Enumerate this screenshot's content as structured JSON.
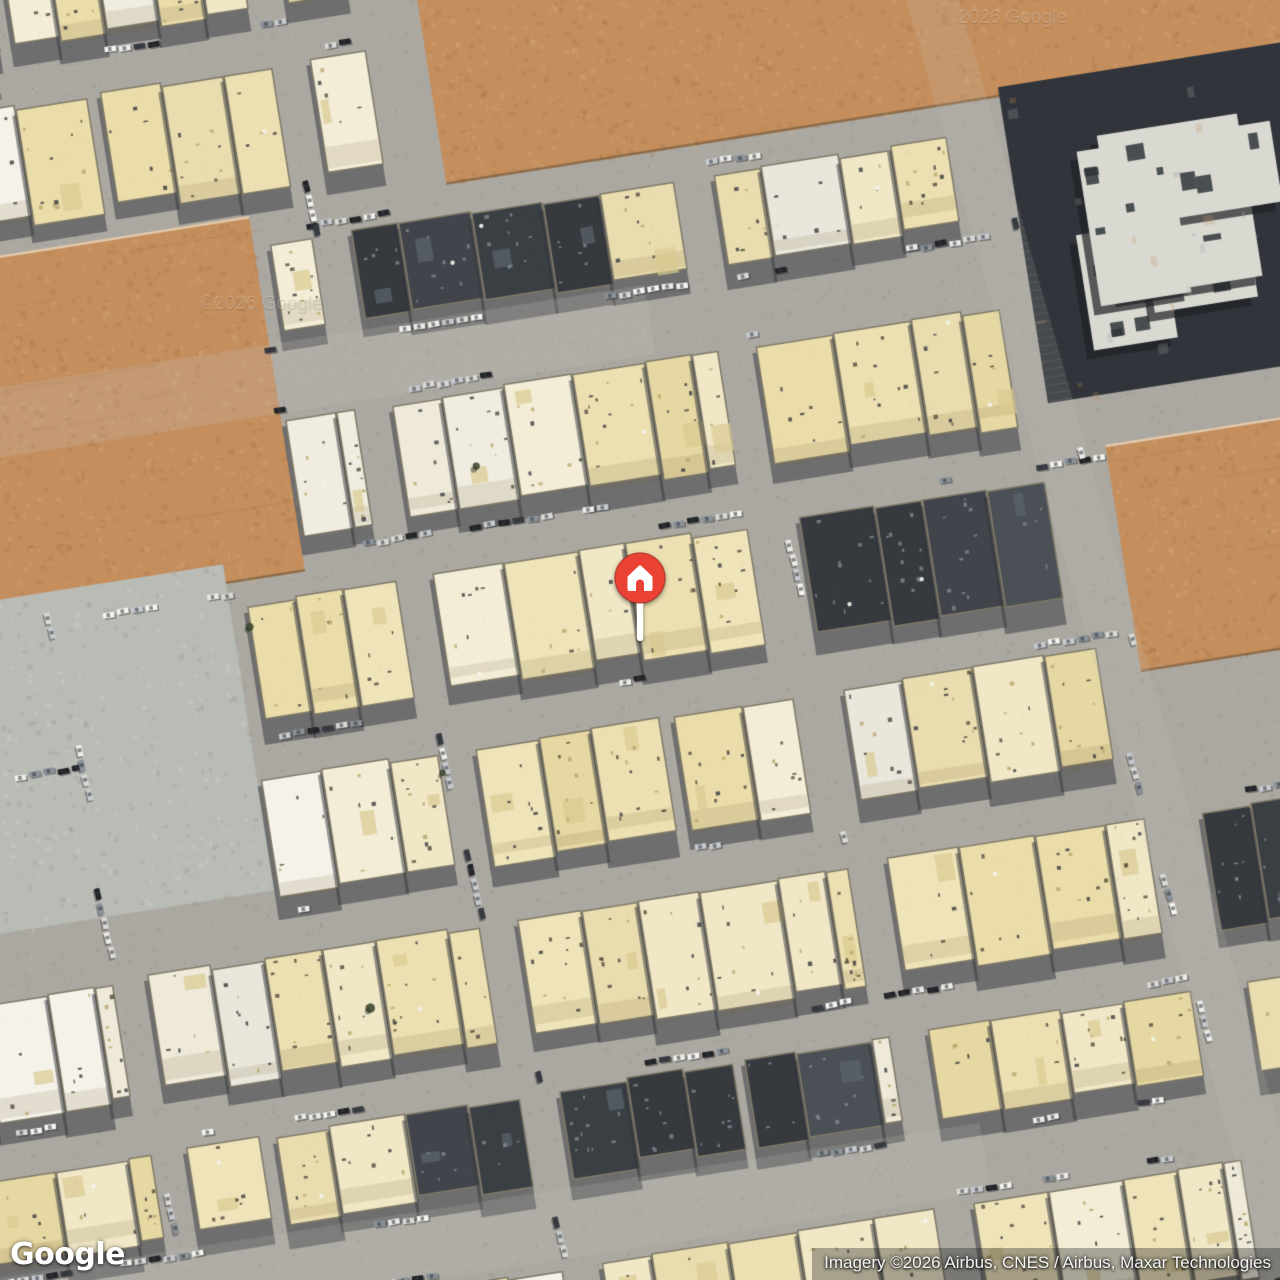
{
  "map": {
    "view_type": "satellite",
    "rotation_deg": -9,
    "seed": 1337,
    "palette": {
      "street": "#a8a5a0",
      "street_light": "#c2c0ba",
      "shadow": "#282c33",
      "house": [
        "#ebdda9",
        "#efe3b9",
        "#e6d7a1",
        "#f1e7c8",
        "#ecdfb0",
        "#f4eed9",
        "#e9dcae"
      ],
      "house_light": [
        "#f1ede1",
        "#efe9da",
        "#f6f3ec",
        "#e9e6dd"
      ],
      "house_dark": [
        "#383d45",
        "#31363e",
        "#424850",
        "#2d3138"
      ],
      "sand": "#c38a58",
      "sand_dark": "#a06a3c",
      "sand_light": "#d9ae82",
      "pavement": "#b7b9b5",
      "estate_roof": "#d8d9d3",
      "estate_dark": "#272b33",
      "tree": "#36412a",
      "car": [
        "#f6f6f4",
        "#ececea",
        "#17191e",
        "#2f333b",
        "#868e98",
        "#c6cad0",
        "#d9d9d7"
      ]
    },
    "rows": {
      "pitch": 176,
      "band": 130,
      "start": -340,
      "wide_rows": [
        3,
        8
      ],
      "wide_band": 100
    },
    "vstreets": [
      {
        "x": 60,
        "w": 30,
        "lean": 0.07
      },
      {
        "x": 430,
        "w": 34,
        "lean": 0.08
      },
      {
        "x": 800,
        "w": 34,
        "lean": 0.09
      },
      {
        "x": 1100,
        "w": 52,
        "lean": 0.12,
        "main": true
      },
      {
        "x": 1460,
        "w": 34,
        "lean": 0.08
      }
    ],
    "zones": {
      "sand": [
        [
          520,
          -360,
          1160,
          520
        ],
        [
          -60,
          160,
          380,
          360
        ],
        [
          1130,
          520,
          300,
          230
        ]
      ],
      "pavement": [
        [
          -60,
          500,
          300,
          330
        ]
      ],
      "estate": [
        [
          1080,
          150,
          340,
          320
        ]
      ],
      "dark": [
        [
          360,
          150,
          340,
          112
        ],
        [
          470,
          40,
          330,
          120
        ],
        [
          820,
          590,
          280,
          110
        ],
        [
          300,
          1040,
          480,
          120
        ],
        [
          880,
          1130,
          320,
          110
        ],
        [
          1140,
          890,
          280,
          110
        ]
      ],
      "light": [
        [
          170,
          250,
          400,
          260
        ],
        [
          -140,
          810,
          360,
          200
        ]
      ]
    },
    "marker": {
      "x": 640,
      "y": 578,
      "color": "#EA4335",
      "ring": "rgba(165,30,20,0.55)",
      "glyph": "home",
      "stem": "#FFFFFF"
    },
    "watermarks": [
      {
        "text": "©2026 Google",
        "x": 200,
        "y": 303
      },
      {
        "text": "2026 Google",
        "x": 958,
        "y": 17
      }
    ]
  },
  "footer": {
    "logo": "Google",
    "attribution": "Imagery ©2026 Airbus, CNES / Airbus, Maxar Technologies"
  }
}
